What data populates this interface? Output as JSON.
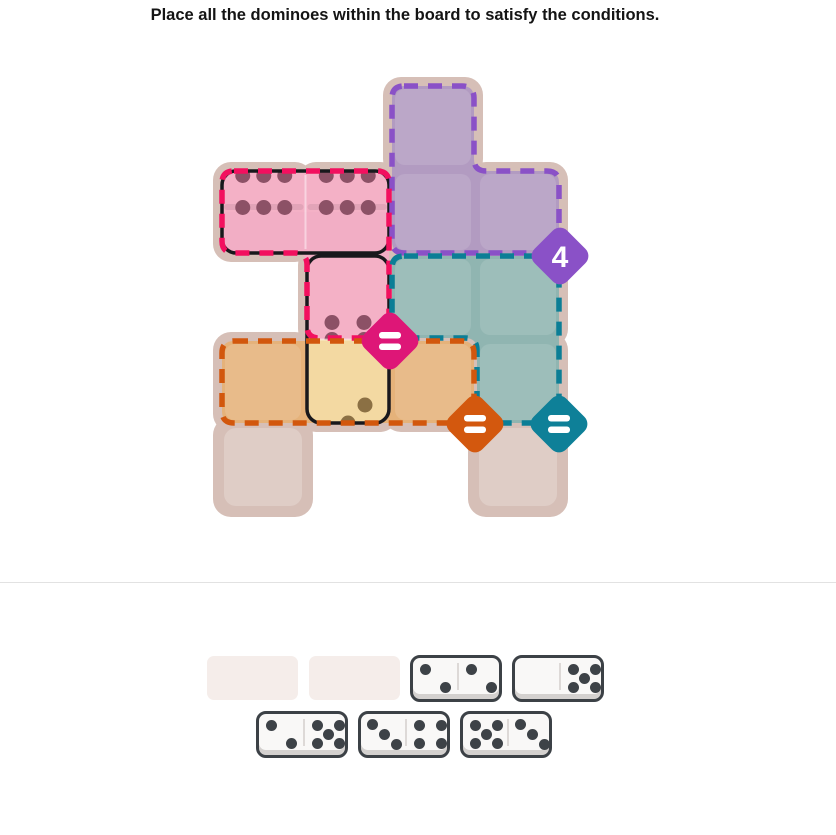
{
  "title": "Place all the dominoes within the board to satisfy the conditions.",
  "colors": {
    "page_background": "#ffffff",
    "board_backdrop": "#d6bfb7",
    "empty_cell_highlight": "rgba(255,255,255,0.22)",
    "region_cell_highlight": "rgba(255,255,255,0.12)",
    "placed_domino_outline": "#18181c",
    "tray_domino_face": "#f9f8f7",
    "tray_domino_border": "#3c4146",
    "tray_pip": "#3d4247",
    "tray_slot": "#f5edea",
    "section_divider": "#e2e2e2"
  },
  "board": {
    "grid": {
      "origin_x": 222,
      "origin_y": 86,
      "pitch": 85,
      "cell": 82
    },
    "cells": [
      [
        0,
        2
      ],
      [
        1,
        0
      ],
      [
        1,
        1
      ],
      [
        1,
        2
      ],
      [
        1,
        3
      ],
      [
        2,
        1
      ],
      [
        2,
        2
      ],
      [
        2,
        3
      ],
      [
        3,
        0
      ],
      [
        3,
        1
      ],
      [
        3,
        2
      ],
      [
        3,
        3
      ],
      [
        4,
        0
      ],
      [
        4,
        3
      ]
    ],
    "regions": [
      {
        "name": "purple",
        "condition_label": "4",
        "condition_type": "sum",
        "cells": [
          [
            0,
            2
          ],
          [
            1,
            2
          ],
          [
            1,
            3
          ]
        ],
        "fill": "#b29bc1",
        "border": "#8a51c7",
        "badge_color": "#8a51c7",
        "badge_at": [
          560,
          256
        ]
      },
      {
        "name": "pink",
        "condition_label": "=",
        "condition_type": "all-equal",
        "cells": [
          [
            1,
            0
          ],
          [
            1,
            1
          ],
          [
            2,
            1
          ]
        ],
        "fill": "#f2aec5",
        "border": "#f2105f",
        "badge_color": "#de1677",
        "badge_at": [
          390,
          341
        ]
      },
      {
        "name": "teal",
        "condition_label": "=",
        "condition_type": "all-equal",
        "cells": [
          [
            2,
            2
          ],
          [
            2,
            3
          ],
          [
            3,
            3
          ]
        ],
        "fill": "#90b5b1",
        "border": "#0b7e96",
        "badge_color": "#0e8098",
        "badge_at": [
          559,
          424
        ]
      },
      {
        "name": "orange",
        "condition_label": "=",
        "condition_type": "all-equal",
        "cells": [
          [
            3,
            0
          ],
          [
            3,
            1
          ],
          [
            3,
            2
          ]
        ],
        "fill": "#e5b27a",
        "border": "#d2570d",
        "badge_color": "#d3580e",
        "badge_at": [
          475,
          424
        ]
      }
    ],
    "placed_dominoes": [
      {
        "id": "6-6",
        "orientation": "horizontal",
        "cells": [
          [
            1,
            0
          ],
          [
            1,
            1
          ]
        ],
        "halves": [
          {
            "pips": 6,
            "pattern": "6h",
            "fill": "#f4b1c6",
            "pip_color": "#8c5166"
          },
          {
            "pips": 6,
            "pattern": "6h",
            "fill": "#f4b1c6",
            "pip_color": "#8c5166"
          }
        ]
      },
      {
        "id": "6-3",
        "orientation": "vertical",
        "cells": [
          [
            2,
            1
          ],
          [
            3,
            1
          ]
        ],
        "halves": [
          {
            "pips": 6,
            "pattern": "6v",
            "fill": "#f4b1c6",
            "pip_color": "#8c5166"
          },
          {
            "pips": 3,
            "pattern": "3anti",
            "fill": "#f3d9a2",
            "pip_color": "#8b7044"
          }
        ]
      }
    ]
  },
  "tray": {
    "empty_slots": 2,
    "dominoes": [
      {
        "left": 2,
        "right": 2
      },
      {
        "left": 0,
        "right": 5
      },
      {
        "left": 2,
        "right": 5
      },
      {
        "left": 3,
        "right": 4
      },
      {
        "left": 5,
        "right": 3
      }
    ]
  }
}
